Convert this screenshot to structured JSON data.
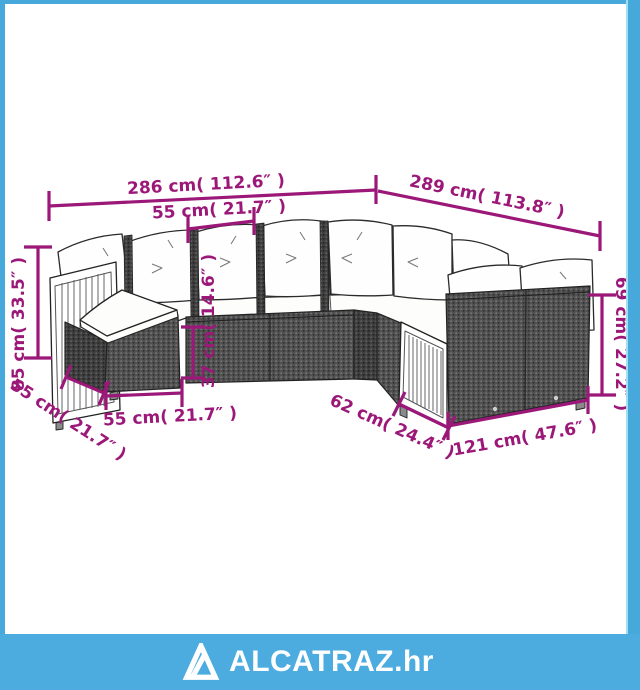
{
  "illustration": {
    "type": "corner-garden-sofa-set-dimension-drawing",
    "annotation_color": "#9b1879",
    "dimensions": {
      "back_length": "286 cm( 112.6″ )",
      "right_length": "289 cm( 113.8″ )",
      "seat_module_width": "55 cm( 21.7″ )",
      "total_height": "85 cm( 33.5″ )",
      "seat_height": "37 cm( 14.6″ )",
      "right_arm_height": "69 cm( 27.2″ )",
      "left_depth": "55 cm( 21.7″ )",
      "ottoman_width": "55 cm( 21.7″ )",
      "right_depth": "62 cm( 24.4″ )",
      "right_front_length": "121 cm( 47.6″ )"
    }
  },
  "frame": {
    "border_color": "#47a9db",
    "border_light": "#9fe0f2",
    "background": "#ffffff"
  },
  "footer": {
    "background": "#4cacdf",
    "brand": "ALCATRAZ.hr"
  }
}
